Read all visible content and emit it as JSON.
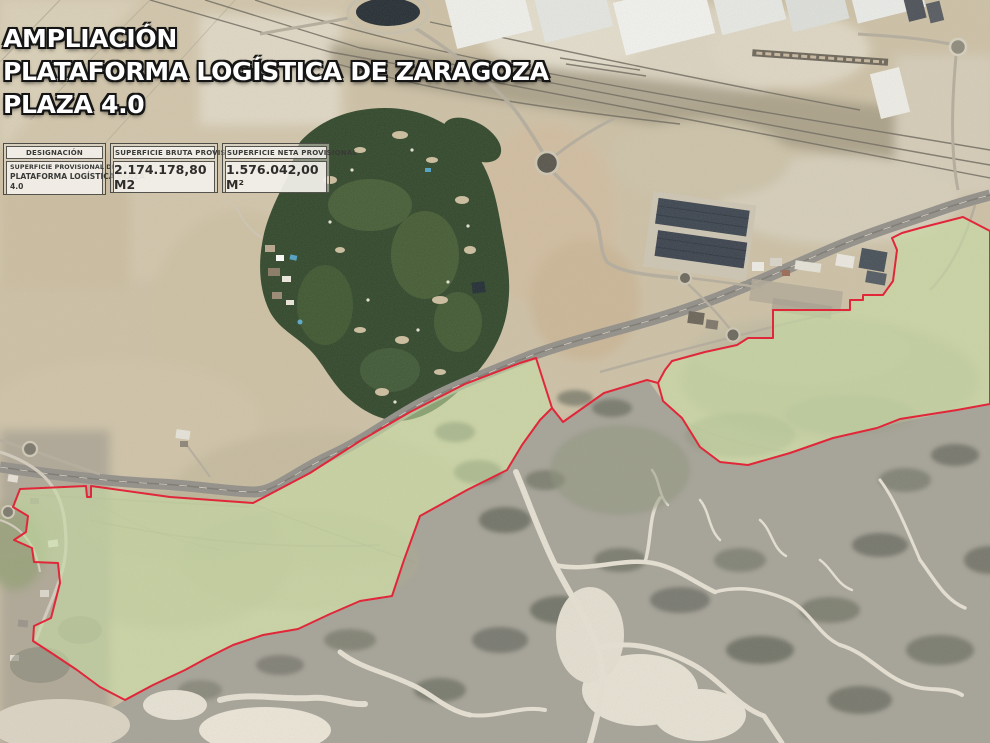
{
  "title": {
    "line1": "AMPLIACIÓN",
    "line2": "PLATAFORMA LOGÍSTICA DE ZARAGOZA",
    "line3": "PLAZA 4.0"
  },
  "info_table": {
    "designacion": {
      "header": "DESIGNACIÓN",
      "value_line1": "SUPERFICIE PROVISIONAL DEL ÁMBITO",
      "value_line2": "PLATAFORMA LOGÍSTICA PLAZA",
      "value_line3": "4.0"
    },
    "superficie_bruta": {
      "header": "SUPERFICIE BRUTA PROVISIONAL",
      "value": "2.174.178,80 M2"
    },
    "superficie_neta": {
      "header": "SUPERFICIE NETA PROVISIONAL",
      "value": "1.576.042,00 M²"
    }
  },
  "overlay": {
    "boundary_color": "#e6192e",
    "fill_color": "#c9e4a5",
    "fill_opacity": 0.58
  }
}
